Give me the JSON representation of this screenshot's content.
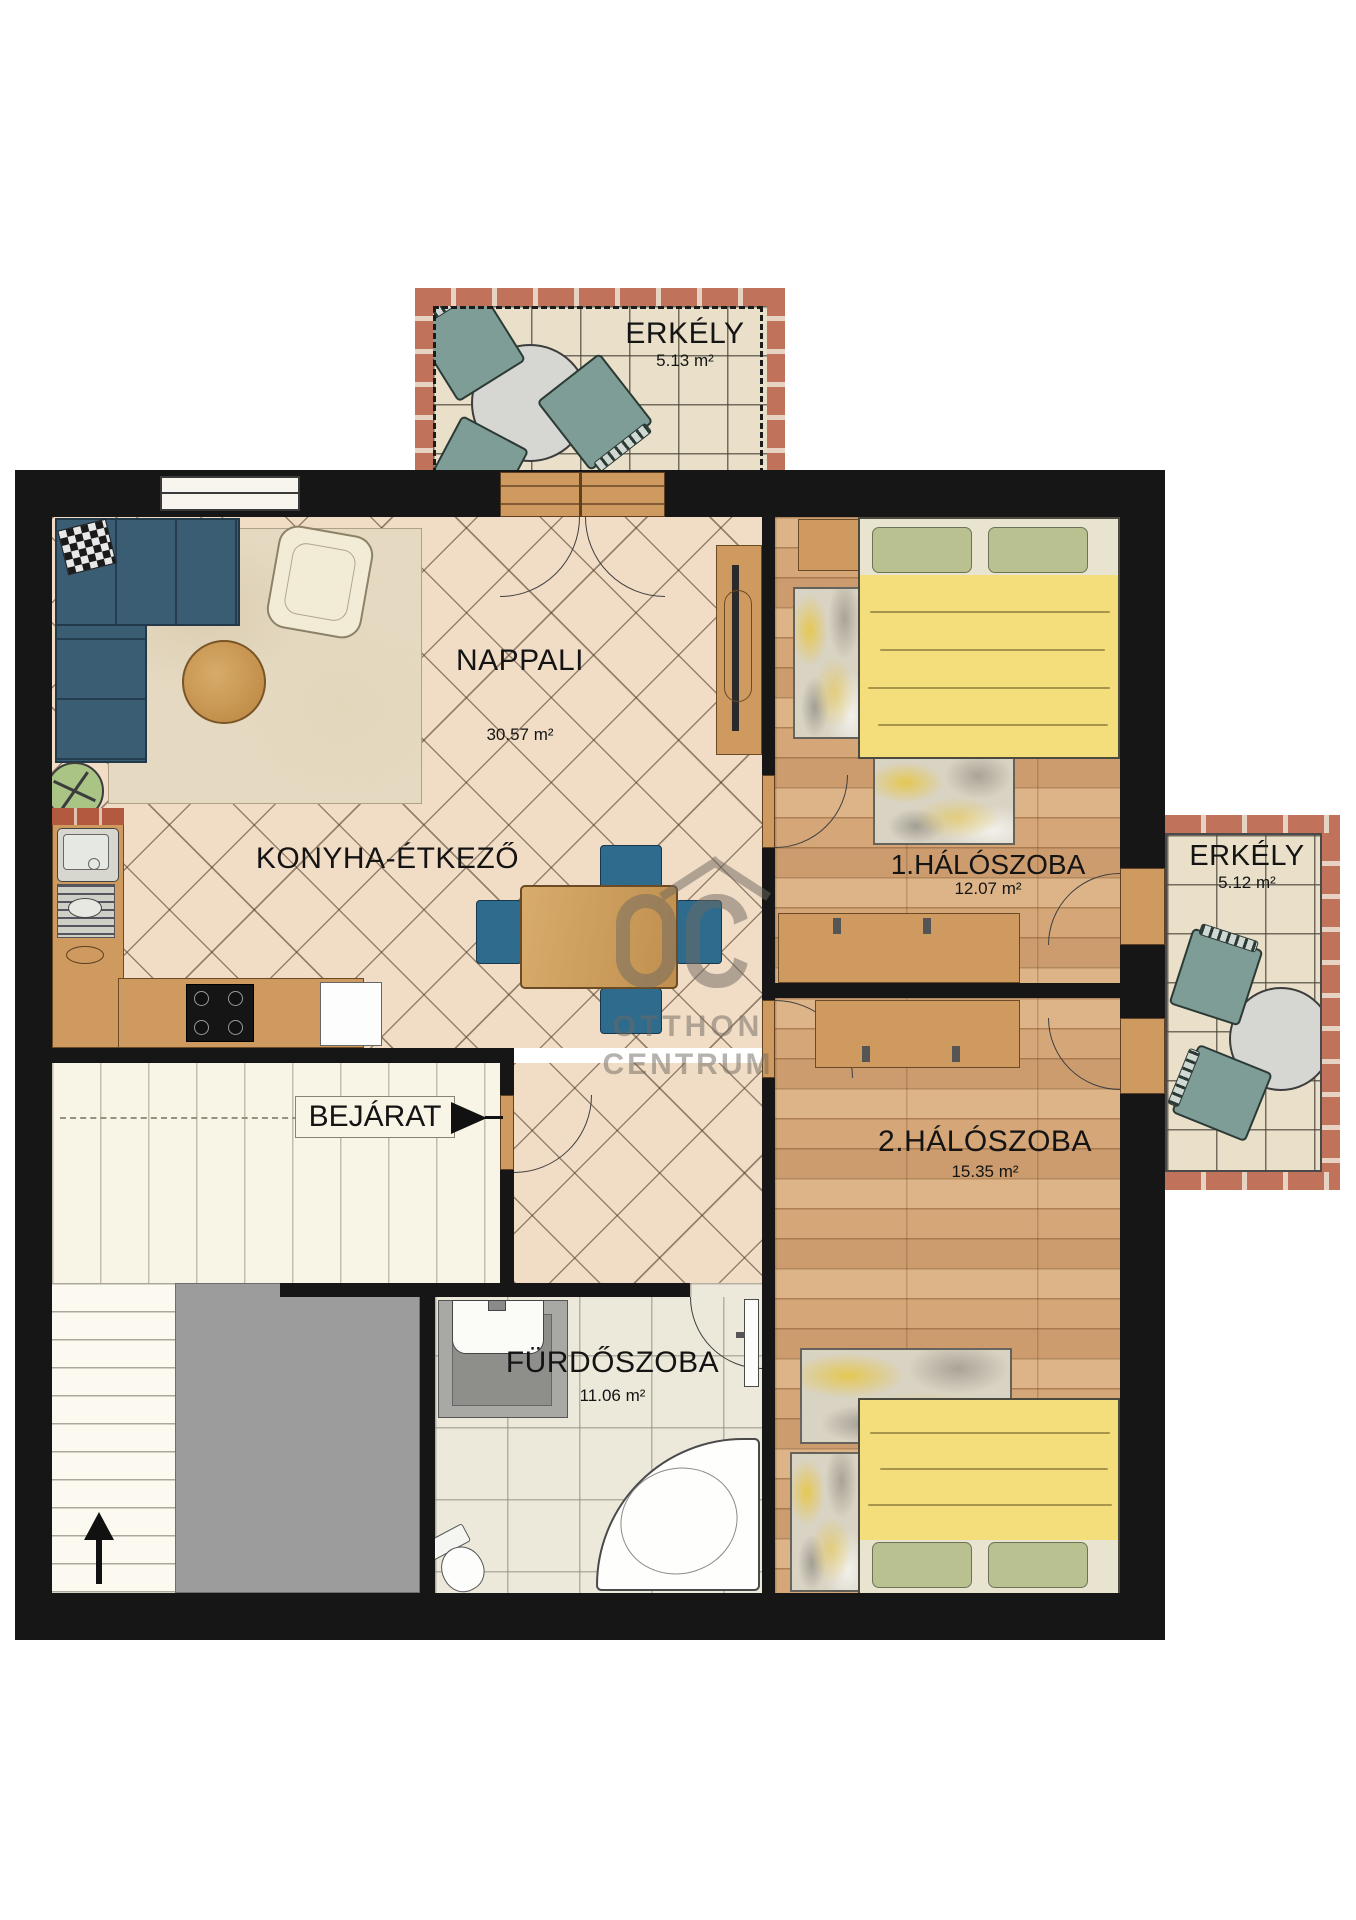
{
  "watermark": {
    "logo": "OC",
    "line1": "OTTHON",
    "line2": "CENTRUM"
  },
  "rooms": {
    "balcony_top": {
      "name": "ERKÉLY",
      "area": "5.13 m²"
    },
    "balcony_right": {
      "name": "ERKÉLY",
      "area": "5.12 m²"
    },
    "living_room": {
      "name": "NAPPALI",
      "area": "30.57 m²"
    },
    "kitchen_dining": {
      "name": "KONYHA-ÉTKEZŐ"
    },
    "bedroom_1": {
      "name": "1.HÁLÓSZOBA",
      "area": "12.07 m²"
    },
    "bedroom_2": {
      "name": "2.HÁLÓSZOBA",
      "area": "15.35 m²"
    },
    "bathroom": {
      "name": "FÜRDŐSZOBA",
      "area": "11.06 m²"
    },
    "entrance": {
      "name": "BEJÁRAT"
    }
  },
  "colors": {
    "wall": "#161616",
    "living_floor": "#f1dcc6",
    "wood_floor": "#d4a678",
    "balcony_tile": "#eae0c9",
    "brick": "#c0735a",
    "bed_blanket": "#f3de7b",
    "pillow_green": "#b9c191",
    "sofa_blue": "#3b5d74",
    "balcony_chair_teal": "#7e9d96",
    "dining_chair_blue": "#2e6b8d",
    "watermark_gray": "#6f6a60"
  }
}
